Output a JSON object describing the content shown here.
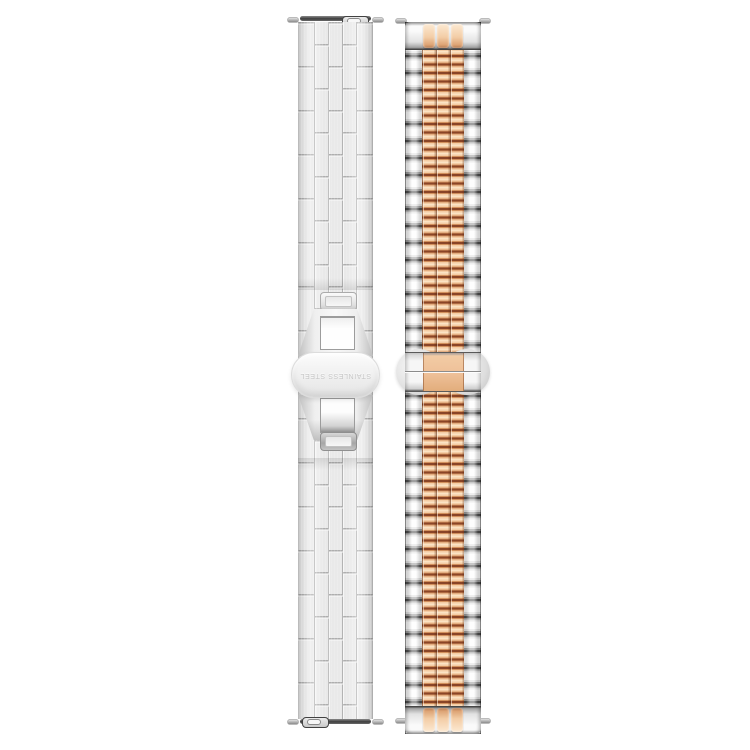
{
  "clasp": {
    "engraving": "STAINLESS STEEL"
  },
  "theme": {
    "page_bg": "#ffffff",
    "steel_base": "#e9e9e9",
    "steel_line": "#b3b3b3",
    "steel_bright": "#fdfdfd",
    "steel_joint": "#4f4f4f",
    "clasp_face": "#f1f1f1",
    "engraving": "#c6c6c6",
    "rose_highlight": "#fbe3c4",
    "rose_light": "#f4cda6",
    "rose_mid": "#d2905d",
    "rose_joint": "#8a4527"
  }
}
